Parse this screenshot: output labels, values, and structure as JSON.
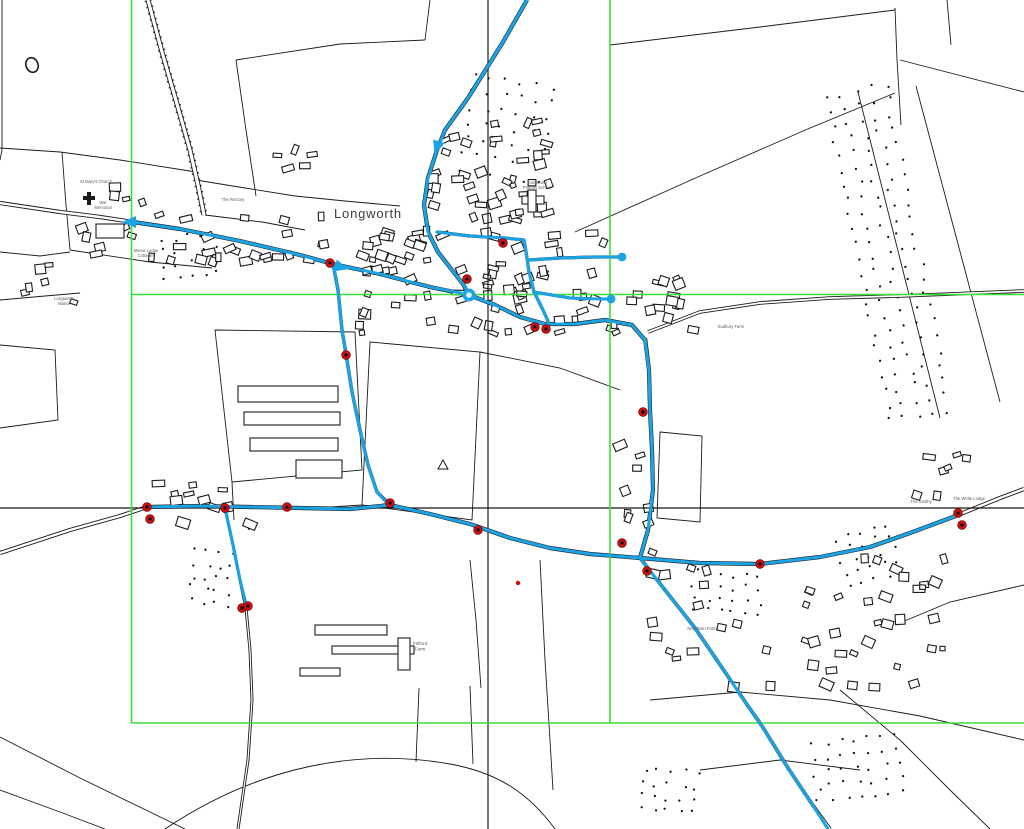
{
  "title": "Longworth network map view",
  "map": {
    "width": 1024,
    "height": 829,
    "colors": {
      "background": "#ffffff",
      "linework": "#1b1b1b",
      "road_fill": "#ffffff",
      "network_blue": "#1ba3e3",
      "grid_green": "#38df38",
      "crosshair_black": "#161616",
      "marker_red": "#cf0e0e",
      "label_gray": "#5a5a5a",
      "town_label_gray": "#3c3c3c"
    },
    "town_label": {
      "text": "Longworth",
      "x": 368,
      "y": 218,
      "size": 13
    },
    "labels": [
      {
        "text": "St Mary's Church",
        "x": 96,
        "y": 183,
        "size": 4.2
      },
      {
        "text": "War Memorial",
        "lines": [
          "War",
          "Memorial"
        ],
        "x": 103,
        "y": 204,
        "size": 4.2
      },
      {
        "text": "The Rectory",
        "x": 233,
        "y": 201,
        "size": 4.2
      },
      {
        "text": "Manor Lodge Cottages",
        "lines": [
          "Manor Lodge",
          "Cottages"
        ],
        "x": 146,
        "y": 252,
        "size": 4.2
      },
      {
        "text": "Longworth Manor",
        "lines": [
          "Longworth",
          "Manor"
        ],
        "x": 64,
        "y": 300,
        "size": 4.2
      },
      {
        "text": "Longworth Primary School",
        "lines": [
          "Longworth",
          "Primary School"
        ],
        "x": 537,
        "y": 184,
        "size": 4.2
      },
      {
        "text": "Sudbury Farm",
        "x": 731,
        "y": 328,
        "size": 4.2
      },
      {
        "text": "The Smithy",
        "x": 921,
        "y": 503,
        "size": 4.2
      },
      {
        "text": "The White Lodge",
        "x": 969,
        "y": 500,
        "size": 4.2
      },
      {
        "text": "Frilford Farm",
        "lines": [
          "Frilford",
          "Farm"
        ],
        "x": 420,
        "y": 645,
        "size": 4.6
      },
      {
        "text": "New Barn Farm",
        "x": 702,
        "y": 630,
        "size": 4.2
      }
    ],
    "green_lines": [
      {
        "x1": 131.5,
        "y1": 0,
        "x2": 131.5,
        "y2": 723
      },
      {
        "x1": 610,
        "y1": 0,
        "x2": 610,
        "y2": 723
      },
      {
        "x1": 131.5,
        "y1": 294.5,
        "x2": 1024,
        "y2": 294.5
      },
      {
        "x1": 131.5,
        "y1": 723,
        "x2": 1024,
        "y2": 723
      }
    ],
    "crosshair": [
      {
        "x1": 0,
        "y1": 508,
        "x2": 1024,
        "y2": 508
      },
      {
        "x1": 488,
        "y1": 0,
        "x2": 488,
        "y2": 829
      }
    ],
    "hatched_road": {
      "d": "M148,0 L162,52 L177,104 L190,150 L198,185 L204,215"
    },
    "roads": [
      {
        "d": "M527,0 L503,42 L468,98 L445,130 L437,150 L428,178 L424,205 L428,232 L438,252 L452,270 L463,284 L469,295",
        "w": 4.2
      },
      {
        "d": "M0,203 L60,212 L100,217 L133,222 L180,229 L240,241 L300,255 L333,264 L380,274 L430,287 L469,295",
        "w": 4.2
      },
      {
        "d": "M469,295 L495,305 L520,317 L545,324 L575,324 L605,320 L632,325 L645,340",
        "w": 4.2
      },
      {
        "d": "M645,338 L649,370 L650,410 L652,450 L653,490 L648,530 L640,558",
        "w": 4.2
      },
      {
        "d": "M648,332 L700,312 L760,303 L830,298 L900,296 L1024,291",
        "w": 3.6
      },
      {
        "d": "M0,553 L70,530 L120,516 L147,507 L200,506 L250,507 L300,508 L350,509 L390,505 L430,514 L470,524 L510,538 L550,548 L590,554 L640,558 L700,563 L760,564 L820,557 L870,547 L910,533 L953,517 L1000,498 L1024,489",
        "w": 4.2
      },
      {
        "d": "M225,508 L233,545 L240,580 L246,608 L250,650 L252,700 L248,760 L238,829",
        "w": 3
      },
      {
        "d": "M640,558 L665,590 L695,628 L725,672 L748,706 L762,726 L788,768 L812,804 L830,829",
        "w": 3.6
      },
      {
        "d": "M333,264 L338,290 L342,330 L347,360 L352,392 L360,430 L368,465 L377,492 L390,505",
        "w": 3.4
      },
      {
        "d": "M437,232 L470,236 L505,238 L524,240",
        "w": 3.2
      },
      {
        "d": "M524,240 L527,258 L529,272 L534,292 L543,310 L548,321",
        "w": 3.2
      },
      {
        "d": "M529,260 L560,258 L595,257 L622,257",
        "w": 3.2
      },
      {
        "d": "M534,292 L570,298 L600,299 L611,299",
        "w": 3
      }
    ],
    "boundaries": [
      "M610,45 L760,27 L895,10",
      "M895,8 L897,60 L901,125",
      "M575,232 L700,176 L810,128 L895,93",
      "M2,0 L2,150 L0,160",
      "M0,148 L60,152 L120,160 L196,172",
      "M62,152 L66,205 L70,250",
      "M0,252 L40,256 L70,252",
      "M70,250 L150,262 L212,268",
      "M205,215 L262,222 L305,230",
      "M196,180 L245,188 L295,196 L345,201 L400,206",
      "M236,60 L246,130 L256,196",
      "M236,60 L340,44 L425,40",
      "M425,40 L430,0",
      "M215,330 L355,332 L362,470 L232,482 Z",
      "M370,342 L480,352 L472,520 L362,505 Z",
      "M232,482 L234,520",
      "M165,829 C260,765 360,748 450,764 C500,773 530,795 555,829",
      "M0,737 L80,778 L150,812 L185,829",
      "M0,790 L60,812 L105,829",
      "M540,560 L545,660 L549,724 L553,790",
      "M650,700 L740,692 L830,700 L920,716 L1024,740",
      "M840,690 L900,740 L950,790 L990,829",
      "M1024,585 L950,602 L895,625",
      "M858,92 L940,418",
      "M916,86 L1000,402",
      "M0,345 L55,350 L58,420 L0,428",
      "M0,300 L45,296 L80,293",
      "M900,60 L1024,92",
      "M947,0 L951,45",
      "M660,432 L702,436 L700,522 L657,518 Z",
      "M470,560 L476,620 L481,688",
      "M700,770 L780,760 L860,770",
      "M419,688 L416,762",
      "M470,686 L473,764",
      "M362,505 L300,509",
      "M480,352 L560,368 L620,390"
    ],
    "network": {
      "width": 3.1,
      "paths": [
        "M527,0 L503,42 L468,98 L445,130 L437,150 L428,178 L424,205 L428,232 L438,252 L452,270 L463,284 L468,292",
        "M133,222 L180,229 L240,241 L300,255 L333,264 L380,274 L430,287 L461,293",
        "M469,295 L495,305 L520,317 L545,324 L575,324 L605,320 L632,325 L645,340 L649,370 L650,410 L652,450 L653,490 L648,530 L640,558",
        "M147,507 L200,506 L250,507 L300,508 L350,509 L390,505 L430,514 L470,524 L510,538 L550,548 L590,554 L640,558 L700,563 L760,564 L820,557 L870,547 L910,533 L953,517",
        "M225,508 L233,545 L240,580 L245,600 L246,606",
        "M640,558 L665,590 L695,628 L725,672 L748,706 L762,726 L788,768 L812,804 L828,829",
        "M333,264 L338,290 L342,330 L347,360 L352,392 L360,430 L368,465 L377,492 L387,503",
        "M437,232 L470,236 L505,238 L524,240",
        "M524,240 L527,258 L529,272 L534,292 L543,310 L548,321",
        "M529,260 L560,258 L595,257 L622,257",
        "M534,292 L570,298 L600,299 L611,299"
      ]
    },
    "nodes": {
      "roundabout": {
        "x": 469,
        "y": 295,
        "r": 6.5
      },
      "dots": [
        {
          "x": 622,
          "y": 257,
          "r": 4.4
        },
        {
          "x": 611,
          "y": 299,
          "r": 4.4
        }
      ]
    },
    "arrows": [
      {
        "x": 130,
        "y": 222,
        "angle": 180
      },
      {
        "x": 341,
        "y": 267,
        "angle": 15
      },
      {
        "x": 437,
        "y": 147,
        "angle": 108
      }
    ],
    "red_markers": [
      {
        "x": 147,
        "y": 507
      },
      {
        "x": 150,
        "y": 519
      },
      {
        "x": 225,
        "y": 508
      },
      {
        "x": 287,
        "y": 507
      },
      {
        "x": 330,
        "y": 263
      },
      {
        "x": 346,
        "y": 355
      },
      {
        "x": 390,
        "y": 503
      },
      {
        "x": 478,
        "y": 530
      },
      {
        "x": 242,
        "y": 608
      },
      {
        "x": 248,
        "y": 606
      },
      {
        "x": 467,
        "y": 279
      },
      {
        "x": 503,
        "y": 243
      },
      {
        "x": 535,
        "y": 327
      },
      {
        "x": 546,
        "y": 329
      },
      {
        "x": 643,
        "y": 412
      },
      {
        "x": 622,
        "y": 543
      },
      {
        "x": 647,
        "y": 571
      },
      {
        "x": 760,
        "y": 564
      },
      {
        "x": 958,
        "y": 513
      },
      {
        "x": 962,
        "y": 525
      }
    ],
    "red_dots": [
      {
        "x": 518,
        "y": 583
      }
    ],
    "stipples": [
      {
        "x": 858,
        "y": 88,
        "w": 64,
        "h": 330,
        "rot": -11,
        "spacing": 15,
        "seed": 11
      },
      {
        "x": 468,
        "y": 82,
        "w": 92,
        "h": 96,
        "rot": 8,
        "spacing": 16,
        "seed": 22
      },
      {
        "x": 163,
        "y": 236,
        "w": 62,
        "h": 40,
        "rot": -6,
        "spacing": 13,
        "seed": 33
      },
      {
        "x": 694,
        "y": 574,
        "w": 72,
        "h": 42,
        "rot": 4,
        "spacing": 13,
        "seed": 44
      },
      {
        "x": 842,
        "y": 528,
        "w": 64,
        "h": 52,
        "rot": -18,
        "spacing": 13,
        "seed": 55
      },
      {
        "x": 194,
        "y": 554,
        "w": 38,
        "h": 48,
        "rot": 6,
        "spacing": 12,
        "seed": 66
      },
      {
        "x": 816,
        "y": 740,
        "w": 88,
        "h": 64,
        "rot": -8,
        "spacing": 14,
        "seed": 77
      },
      {
        "x": 643,
        "y": 772,
        "w": 62,
        "h": 40,
        "rot": 5,
        "spacing": 13,
        "seed": 88
      }
    ],
    "building_clusters": [
      {
        "x": 352,
        "y": 225,
        "w": 268,
        "h": 112,
        "n": 85,
        "seed": 1
      },
      {
        "x": 425,
        "y": 118,
        "w": 130,
        "h": 106,
        "n": 38,
        "seed": 2
      },
      {
        "x": 622,
        "y": 276,
        "w": 78,
        "h": 64,
        "n": 14,
        "seed": 3
      },
      {
        "x": 140,
        "y": 212,
        "w": 192,
        "h": 54,
        "n": 26,
        "seed": 4
      },
      {
        "x": 60,
        "y": 182,
        "w": 86,
        "h": 76,
        "n": 10,
        "seed": 5
      },
      {
        "x": 150,
        "y": 478,
        "w": 112,
        "h": 52,
        "n": 12,
        "seed": 6
      },
      {
        "x": 646,
        "y": 546,
        "w": 306,
        "h": 148,
        "n": 52,
        "seed": 7
      },
      {
        "x": 610,
        "y": 426,
        "w": 54,
        "h": 128,
        "n": 8,
        "seed": 8
      },
      {
        "x": 498,
        "y": 178,
        "w": 66,
        "h": 40,
        "n": 8,
        "seed": 10
      },
      {
        "x": 912,
        "y": 452,
        "w": 62,
        "h": 50,
        "n": 7,
        "seed": 14
      },
      {
        "x": 20,
        "y": 262,
        "w": 60,
        "h": 44,
        "n": 6,
        "seed": 15
      },
      {
        "x": 253,
        "y": 140,
        "w": 82,
        "h": 36,
        "n": 5,
        "seed": 16
      }
    ],
    "buildings": [
      [
        238,
        386,
        100,
        16
      ],
      [
        244,
        412,
        96,
        13
      ],
      [
        250,
        438,
        88,
        13
      ],
      [
        296,
        460,
        46,
        18
      ],
      [
        315,
        625,
        72,
        10
      ],
      [
        332,
        646,
        82,
        8
      ],
      [
        398,
        638,
        12,
        32
      ],
      [
        300,
        668,
        40,
        8
      ],
      [
        522,
        196,
        22,
        8
      ],
      [
        528,
        190,
        8,
        22
      ],
      [
        96,
        224,
        28,
        14
      ]
    ],
    "symbols": {
      "pond": {
        "x": 32,
        "y": 65
      },
      "triangle": {
        "x": 443,
        "y": 465
      },
      "church": {
        "x": 84,
        "y": 192
      }
    }
  }
}
